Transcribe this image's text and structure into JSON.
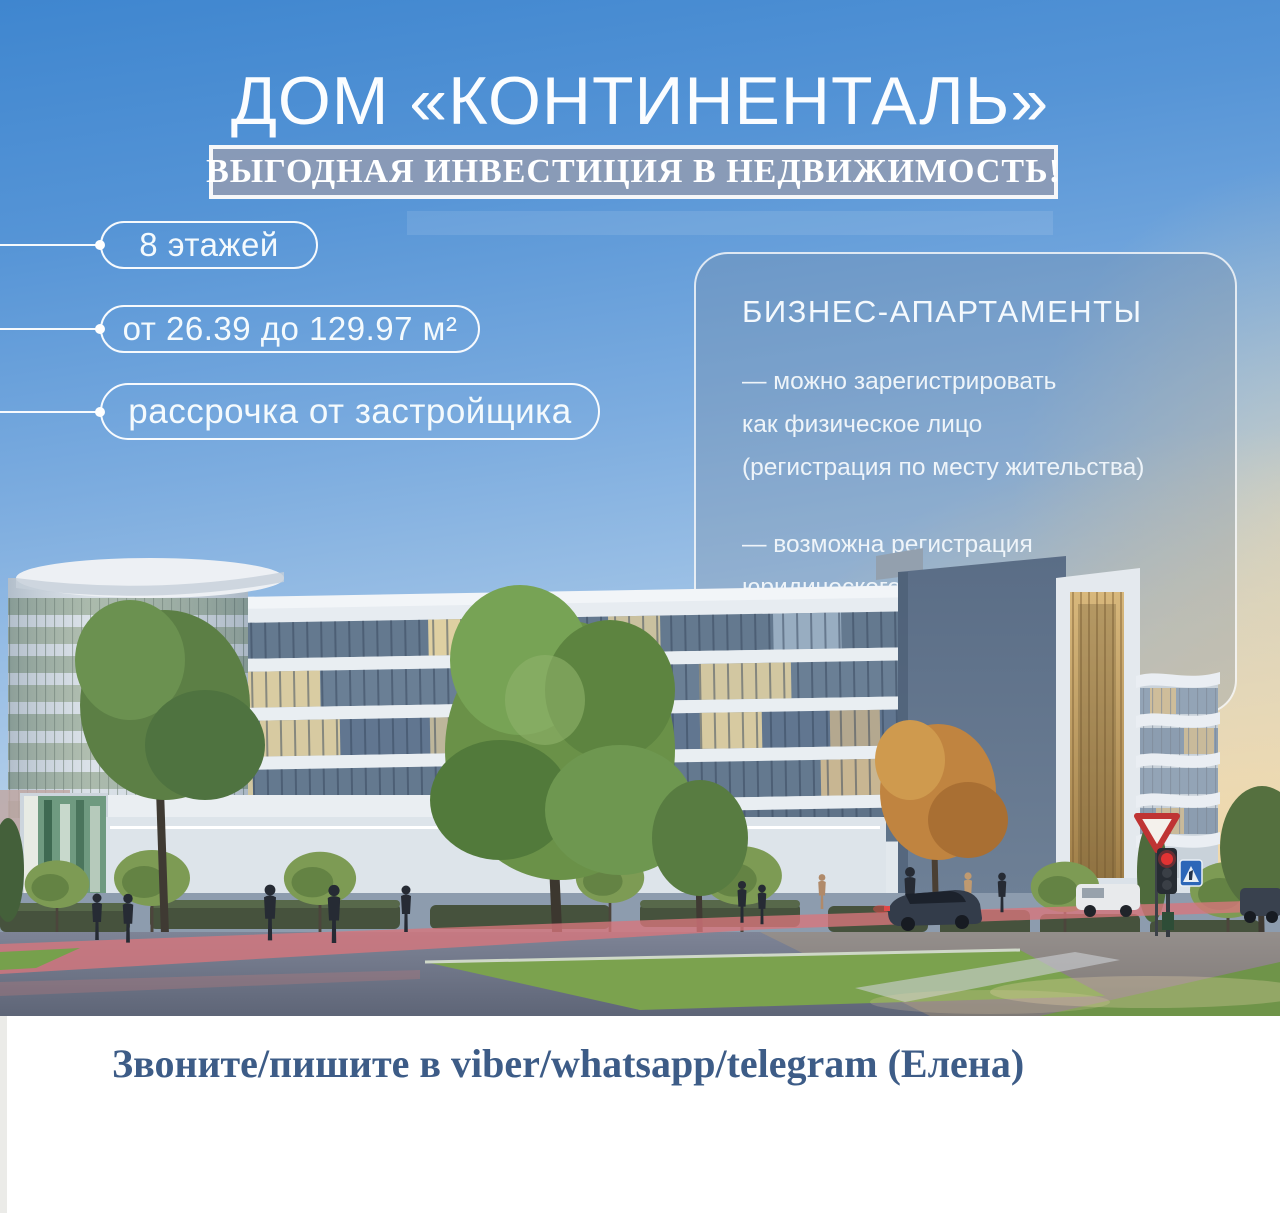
{
  "poster": {
    "title": "ДОМ «КОНТИНЕНТАЛЬ»",
    "banner": "ВЫГОДНАЯ ИНВЕСТИЦИЯ В НЕДВИЖИМОСТЬ!",
    "features": [
      {
        "label": "8 этажей"
      },
      {
        "label": "от 26.39 до 129.97 м²"
      },
      {
        "label": "рассрочка от застройщика"
      }
    ],
    "card": {
      "heading": "БИЗНЕС-АПАРТАМЕНТЫ",
      "bullets": [
        {
          "lines": [
            "— можно зарегистрировать",
            "как физическое лицо",
            "(регистрация по месту жительства)"
          ]
        },
        {
          "lines": [
            "— возможна регистрация",
            "юридического лица",
            "(компании любой формы собственности)"
          ]
        }
      ]
    },
    "footer": {
      "contact": "Звоните/пишите в viber/whatsapp/telegram (Елена)"
    }
  },
  "colors": {
    "sky_top": "#3f86cf",
    "sky_horizon_warm": "#f3d8a4",
    "banner_bg": "#8d9bb5",
    "banner_border": "#f6f7f9",
    "pill_border": "#ffffff",
    "card_border": "#ffffff",
    "card_tint": "#7c8ba0",
    "text_light": "#ffffff",
    "footer_bg": "#ffffff",
    "footer_text": "#3d5c87",
    "bike_lane_red": "#d9767c",
    "traffic_light_red": "#e23434"
  }
}
